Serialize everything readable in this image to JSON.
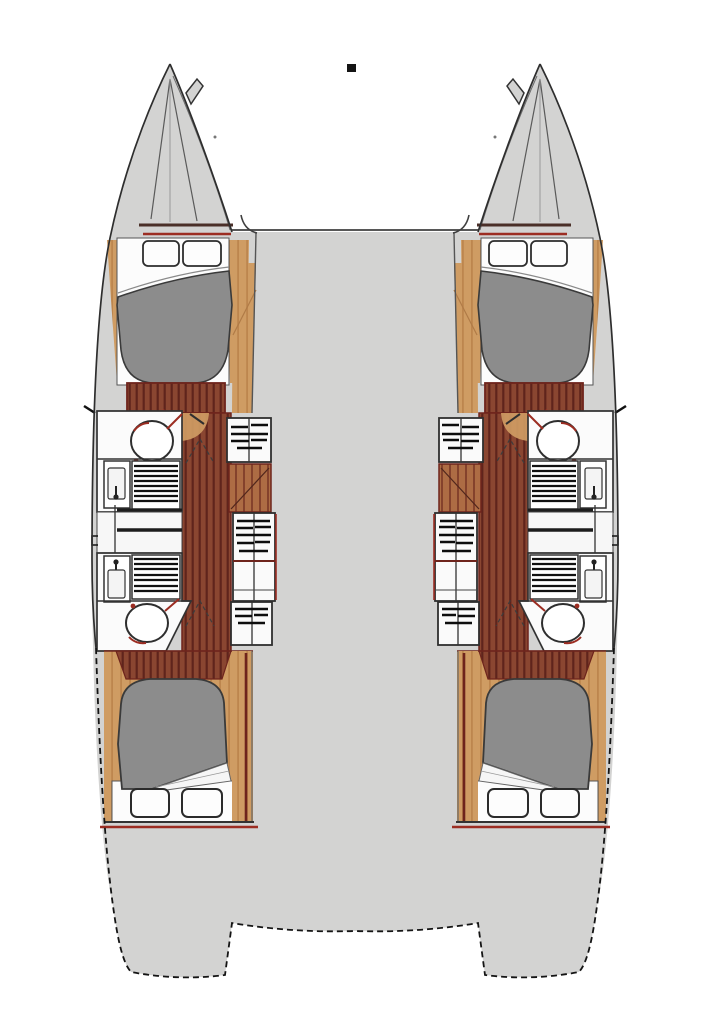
{
  "document": {
    "kind": "boat-floorplan-diagram",
    "subject": "Catamaran yacht deck plan, top-down view, bow up, 4 cabins / 4 heads, mirrored port and starboard hulls",
    "visible_text": "",
    "marker": "small black square near top center"
  },
  "colors": {
    "background": "#ffffff",
    "deck": "#d3d3d2",
    "deckOutline": "#2e2e2e",
    "bed": "#8c8c8c",
    "bedOutline": "#3a3a3a",
    "white": "#fbfbfb",
    "woodDark": "#8a4631",
    "woodStripe": "#5f241c",
    "woodMid": "#ad6c44",
    "woodMidStripe": "#84422c",
    "tan": "#cf9c63",
    "tanStripe": "#bd864e",
    "maroon": "#6e241c",
    "red": "#9c2d22",
    "ink": "#141414"
  },
  "plan": {
    "bridgedeck": {
      "name": "central bridge deck",
      "features": [
        "open gray deck between hulls",
        "rounded front coachroof corners",
        "stern cutout notch between transoms"
      ]
    },
    "hulls": [
      {
        "side": "port (left)",
        "rooms": [
          {
            "name": "bow locker",
            "features": [
              "pointed bow",
              "inner V lines",
              "anchor fitting",
              "double bulkhead lines"
            ]
          },
          {
            "name": "forward cabin",
            "features": [
              "double berth",
              "2 pillows at head (bow side)",
              "gray duvet",
              "wood plank floor at foot",
              "tan side walls"
            ]
          },
          {
            "name": "forward head",
            "features": [
              "toilet",
              "sink with faucet",
              "shower grate"
            ]
          },
          {
            "name": "companionway and storage",
            "features": [
              "hatched step boxes",
              "wood panel",
              "corridor with plank floor",
              "door swing marks"
            ]
          },
          {
            "name": "aft head",
            "features": [
              "shower grate",
              "sink with faucet",
              "toilet"
            ]
          },
          {
            "name": "aft cabin",
            "features": [
              "double berth",
              "gray duvet with turned sheet",
              "2 pillows at foot (stern side)",
              "wood floor",
              "tan walls"
            ]
          },
          {
            "name": "stern platform",
            "features": [
              "dashed hull outline",
              "sugar-scoop transom"
            ]
          }
        ]
      },
      {
        "side": "starboard (right)",
        "rooms": [
          {
            "name": "bow locker",
            "features": [
              "mirror of port hull"
            ]
          },
          {
            "name": "forward cabin",
            "features": [
              "mirror of port hull"
            ]
          },
          {
            "name": "forward head",
            "features": [
              "mirror of port hull"
            ]
          },
          {
            "name": "companionway and storage",
            "features": [
              "mirror of port hull"
            ]
          },
          {
            "name": "aft head",
            "features": [
              "mirror of port hull"
            ]
          },
          {
            "name": "aft cabin",
            "features": [
              "mirror of port hull"
            ]
          },
          {
            "name": "stern platform",
            "features": [
              "mirror of port hull"
            ]
          }
        ]
      }
    ]
  }
}
